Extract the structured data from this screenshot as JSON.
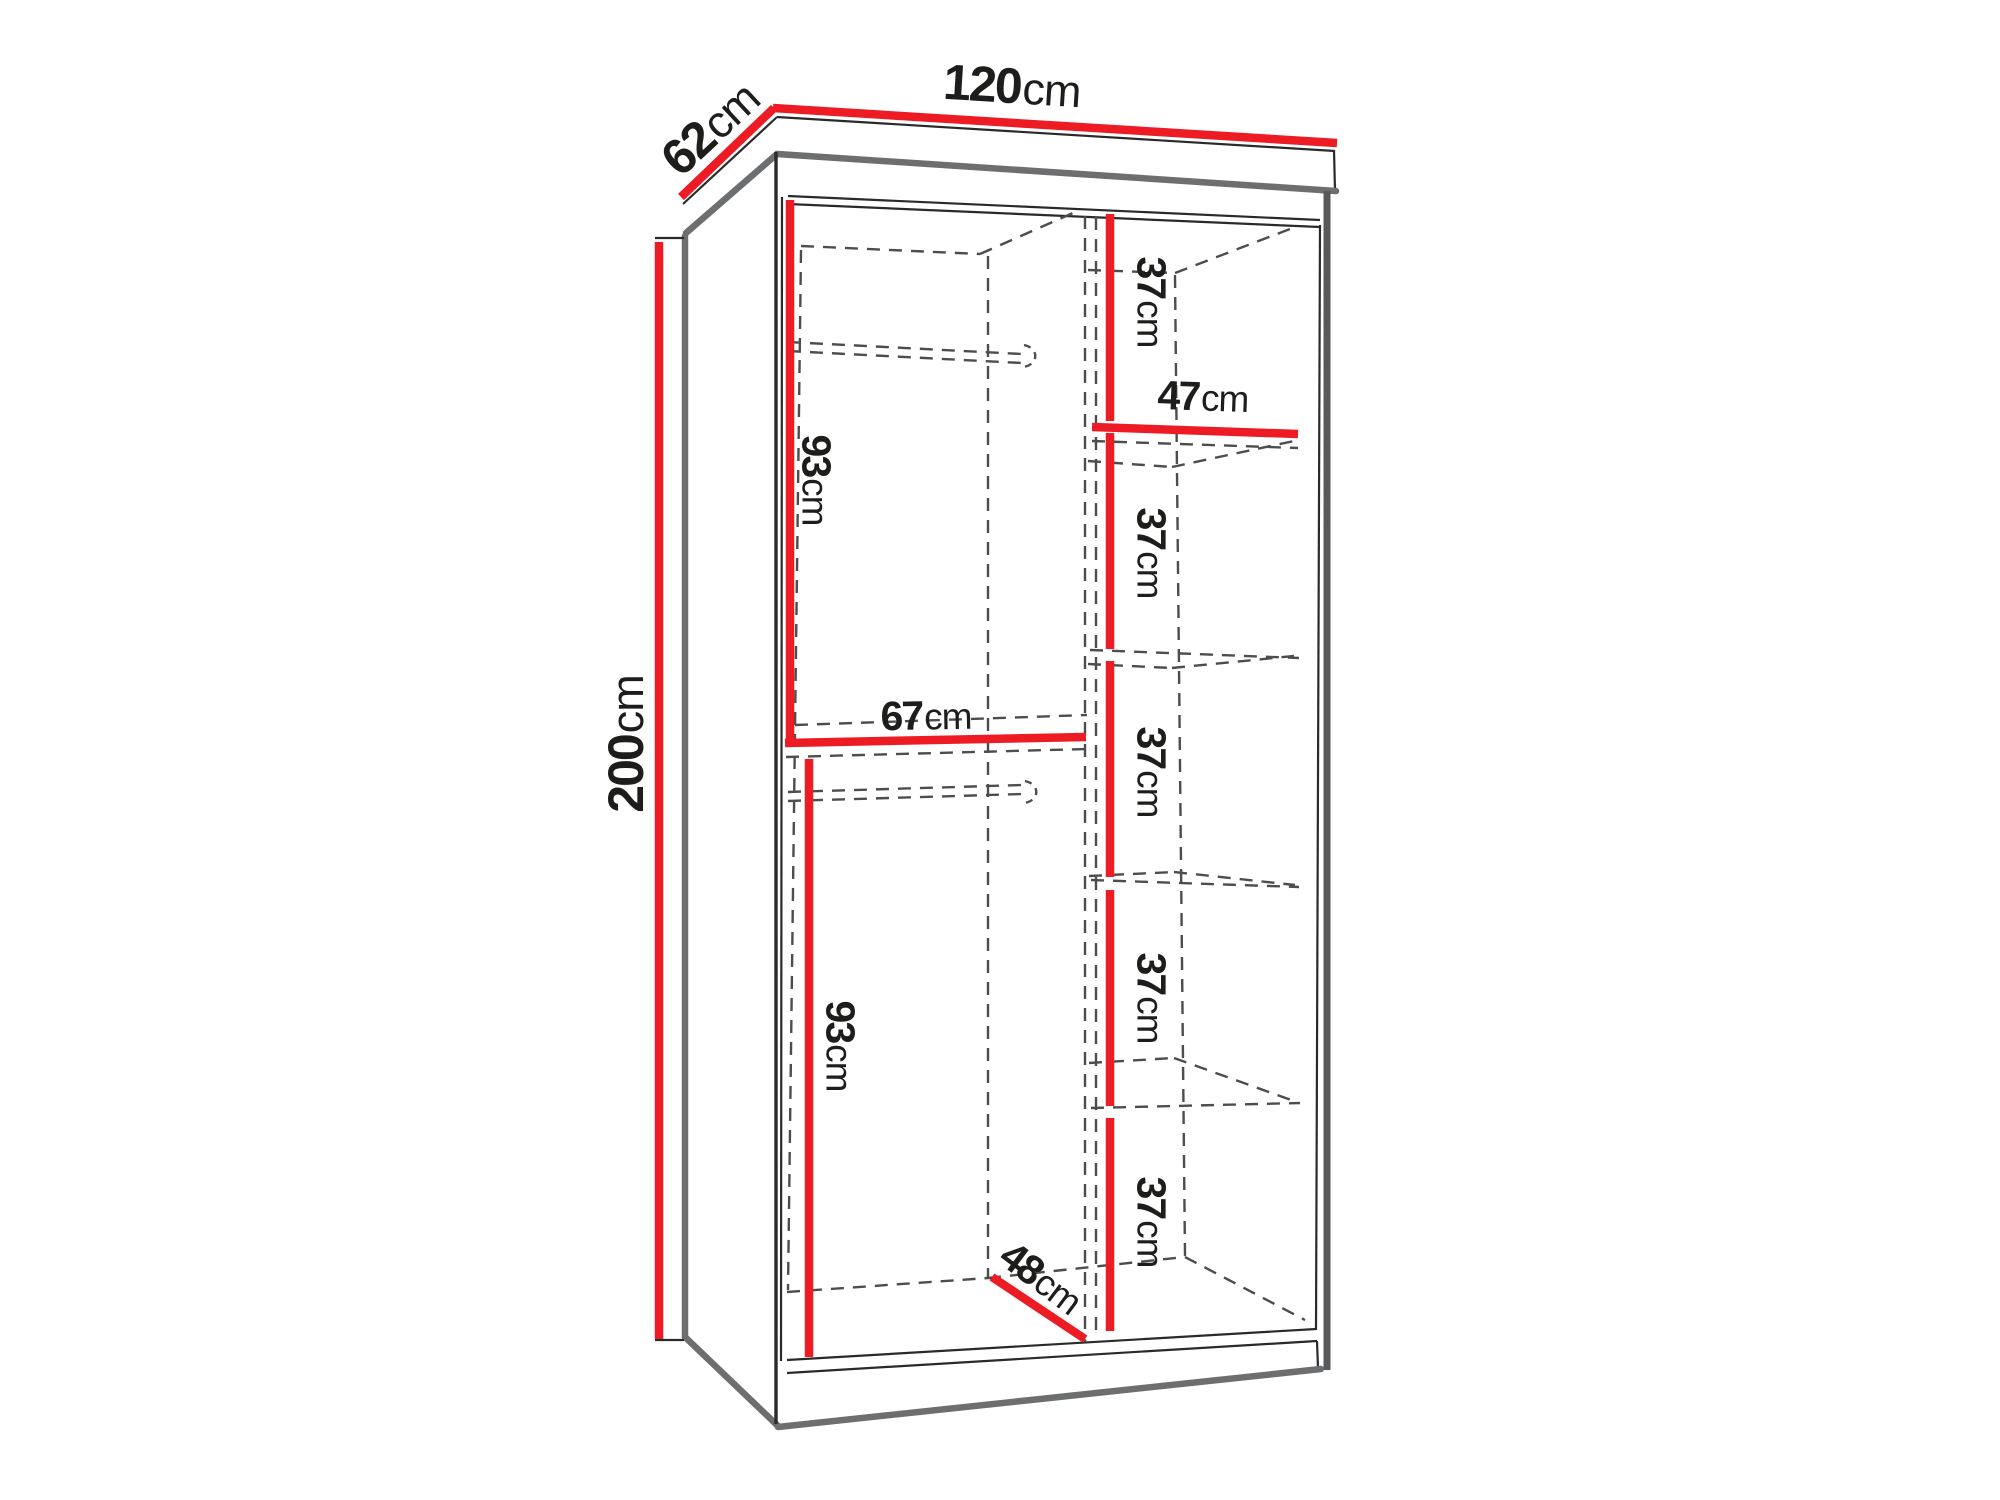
{
  "colors": {
    "background": "#ffffff",
    "dimension_red": "#ed1c24",
    "outline_dark": "#2a2a2a",
    "edge_gray": "#6d6e70",
    "right_edge_gray": "#58595b",
    "hidden_gray": "#4d4d4d",
    "label_black": "#1d1d1b"
  },
  "dimensions": {
    "width": {
      "value": "120",
      "unit": "cm"
    },
    "depth": {
      "value": "62",
      "unit": "cm"
    },
    "height": {
      "value": "200",
      "unit": "cm"
    },
    "left_top_section_height": {
      "value": "93",
      "unit": "cm"
    },
    "left_shelf_width": {
      "value": "67",
      "unit": "cm"
    },
    "left_bottom_section_height": {
      "value": "93",
      "unit": "cm"
    },
    "interior_depth": {
      "value": "48",
      "unit": "cm"
    },
    "right_shelf_width": {
      "value": "47",
      "unit": "cm"
    },
    "right_section_heights": [
      {
        "value": "37",
        "unit": "cm"
      },
      {
        "value": "37",
        "unit": "cm"
      },
      {
        "value": "37",
        "unit": "cm"
      },
      {
        "value": "37",
        "unit": "cm"
      },
      {
        "value": "37",
        "unit": "cm"
      }
    ]
  }
}
